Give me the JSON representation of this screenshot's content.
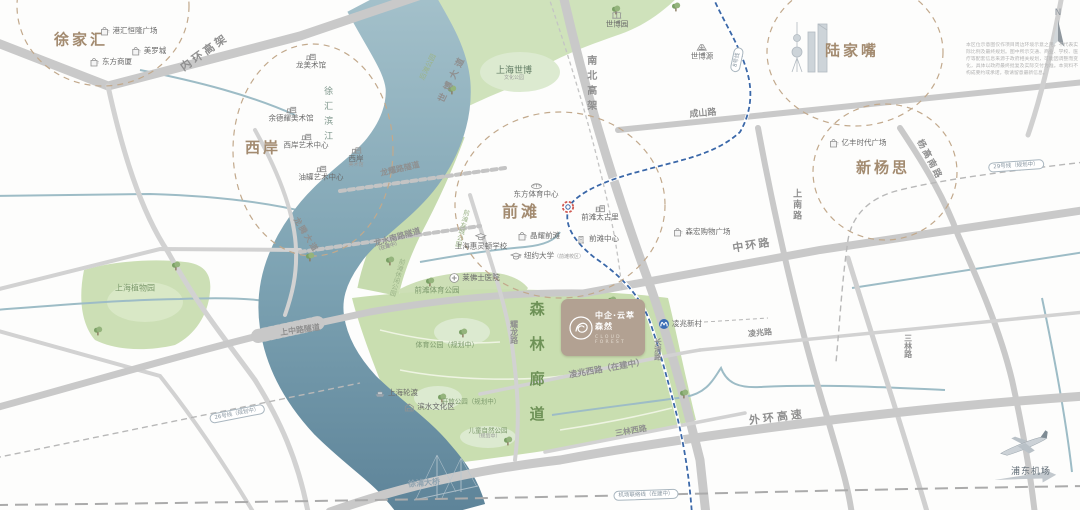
{
  "meta": {
    "compass_label": "N"
  },
  "project": {
    "name": "中企·云萃森然",
    "name_en": "CLOUD FOREST"
  },
  "airport": {
    "label": "浦东机场"
  },
  "disclaimer": "本区位示意图仅作项目周边环境示意之用，不代表实际比例及最终规划。图中所示交通、商业、学校、医疗等配套信息来源于政府相关规划，可能因调整而变化，具体以政府最终批复及实际交付为准。本资料不构成要约或承诺，敬请留意最新信息。",
  "map": {
    "width": 1080,
    "height": 510,
    "colors": {
      "district": "#a38b70",
      "road_label": "#8f8f8f",
      "river": "#7ca2b2",
      "park": "#cbdfb3",
      "metro_line8": "#3b68a8",
      "project_card": "#b2a192",
      "forest_text": "#6e9257"
    },
    "districts": [
      {
        "id": "district-xujiahui",
        "text": "徐家汇",
        "x": 81,
        "y": 40,
        "size": 15
      },
      {
        "id": "district-xian",
        "text": "西岸",
        "x": 263,
        "y": 148,
        "size": 15
      },
      {
        "id": "district-qiantan",
        "text": "前滩",
        "x": 521,
        "y": 212,
        "size": 16
      },
      {
        "id": "district-lujiazui",
        "text": "陆家嘴",
        "x": 852,
        "y": 51,
        "size": 15
      },
      {
        "id": "district-xinyangsi",
        "text": "新杨思",
        "x": 883,
        "y": 168,
        "size": 15
      }
    ],
    "road_labels": [
      {
        "id": "neihuan-elevated",
        "text": "内环高架",
        "x": 205,
        "y": 53,
        "rot": -35,
        "size": 11,
        "ls": 3
      },
      {
        "id": "nanbei-elevated",
        "text": "南北高架",
        "x": 590,
        "y": 85,
        "vertical": true,
        "size": 10,
        "ls": 5
      },
      {
        "id": "chengshan-road",
        "text": "成山路",
        "x": 703,
        "y": 114,
        "rot": -5,
        "size": 9
      },
      {
        "id": "yanggaonan-road",
        "text": "杨高南路",
        "x": 929,
        "y": 160,
        "rot": 62,
        "size": 9,
        "ls": 2
      },
      {
        "id": "shangnan-road",
        "text": "上南路",
        "x": 796,
        "y": 205,
        "vertical": true,
        "size": 9,
        "ls": 2
      },
      {
        "id": "zhonghuan-road",
        "text": "中环路",
        "x": 752,
        "y": 246,
        "rot": -9,
        "size": 11,
        "ls": 2
      },
      {
        "id": "shibo-avenue",
        "text": "世博大道",
        "x": 453,
        "y": 79,
        "rot": -64,
        "size": 9,
        "ls": 4
      },
      {
        "id": "longteng-avenue",
        "text": "龙腾大道",
        "x": 306,
        "y": 235,
        "rot": 58,
        "size": 8,
        "ls": 2
      },
      {
        "id": "longyao-road-tunnel",
        "text": "龙耀路隧道",
        "x": 400,
        "y": 169,
        "rot": -13,
        "size": 8
      },
      {
        "id": "longshuinan-road-tunnel",
        "lines": [
          "龙水南路隧道",
          "（在建中）"
        ],
        "x": 398,
        "y": 240,
        "rot": -16,
        "size": 8
      },
      {
        "id": "shangzhong-road-tunnel",
        "text": "上中路隧道",
        "x": 300,
        "y": 330,
        "rot": -8,
        "size": 8
      },
      {
        "id": "yaolong-road",
        "text": "耀龙路",
        "x": 514,
        "y": 332,
        "vertical": true,
        "size": 8
      },
      {
        "id": "changqing-road",
        "text": "长清路",
        "x": 657,
        "y": 349,
        "vertical": true,
        "size": 7.5
      },
      {
        "id": "lingzhaoxi-road",
        "text": "凌兆西路（在建中）",
        "x": 607,
        "y": 370,
        "rot": -10,
        "size": 8.5
      },
      {
        "id": "lingzhao-road",
        "text": "凌兆路",
        "x": 760,
        "y": 333,
        "rot": -5,
        "size": 8
      },
      {
        "id": "sanlinxi-road",
        "text": "三林西路",
        "x": 631,
        "y": 431,
        "rot": -10,
        "size": 8
      },
      {
        "id": "sanlin-road",
        "text": "三林路",
        "x": 908,
        "y": 346,
        "vertical": true,
        "size": 8
      },
      {
        "id": "waihuan-expressway",
        "text": "外环高速",
        "x": 777,
        "y": 418,
        "rot": -7,
        "size": 11,
        "ls": 3
      },
      {
        "id": "xupu-bridge",
        "text": "徐浦大桥",
        "x": 424,
        "y": 483,
        "rot": -5,
        "size": 8,
        "color": "#8fa3b0"
      }
    ],
    "transit_capsules": [
      {
        "id": "metro-line-8",
        "text": "8号线",
        "x": 737,
        "y": 60,
        "rot": -78
      },
      {
        "id": "metro-line-26-planned",
        "text": "26号线（规划中）",
        "x": 237,
        "y": 414,
        "rot": -11
      },
      {
        "id": "metro-line-29-planned",
        "text": "29号线（规划中）",
        "x": 1016,
        "y": 166,
        "rot": -4
      },
      {
        "id": "airport-link-line",
        "text": "机场联络线（在建中）",
        "x": 646,
        "y": 495,
        "rot": -2
      }
    ],
    "green_labels": [
      {
        "id": "houtan-park",
        "text": "后滩公园",
        "x": 428,
        "y": 67,
        "rot": -64,
        "size": 7,
        "color": "#9cb489"
      },
      {
        "id": "expo-culture-park",
        "lines": [
          "上海世博",
          "文化公园"
        ],
        "x": 514,
        "y": 74,
        "size": 9,
        "color": "#5f7a62"
      },
      {
        "id": "qiantan-youcheng-park",
        "text": "前滩友城公园",
        "x": 461,
        "y": 228,
        "vertical": true,
        "rot": 14,
        "size": 6.5,
        "color": "#9cb489"
      },
      {
        "id": "qiantan-xiuxian-park",
        "text": "前滩休闲公园",
        "x": 396,
        "y": 277,
        "vertical": true,
        "rot": 16,
        "size": 6.5,
        "color": "#9cb489"
      },
      {
        "id": "qiantan-sports-park",
        "text": "前滩体育公园",
        "x": 437,
        "y": 291,
        "size": 7.5,
        "color": "#7d9a6d"
      },
      {
        "id": "sports-park-planned",
        "text": "体育公园（规划中）",
        "x": 447,
        "y": 345,
        "size": 7,
        "color": "#7d9a6d"
      },
      {
        "id": "shanghai-botanical-garden",
        "text": "上海植物园",
        "x": 135,
        "y": 288,
        "size": 8,
        "color": "#7d9a6d"
      },
      {
        "id": "open-park-planned",
        "text": "开放公园（规划中）",
        "x": 471,
        "y": 402,
        "size": 6.5,
        "color": "#7d9a6d"
      },
      {
        "id": "children-nature-park-planned",
        "lines": [
          "儿童自然公园",
          "（规划中）"
        ],
        "x": 488,
        "y": 434,
        "size": 6.5,
        "color": "#7d9a6d"
      },
      {
        "id": "forest-corridor",
        "text": "森林廊道",
        "x": 536,
        "y": 371,
        "vertical": true,
        "size": 15,
        "bold": true,
        "ls": 20,
        "color": "#6e9257"
      },
      {
        "id": "xuhui-riverside",
        "text": "徐汇滨江",
        "x": 327,
        "y": 116,
        "vertical": true,
        "size": 9,
        "ls": 6,
        "color": "#7f978c"
      }
    ],
    "pois": [
      {
        "id": "ganghui-henglong-plaza",
        "icon": "bag",
        "text": "港汇恒隆广场",
        "x": 128,
        "y": 31
      },
      {
        "id": "metro-city",
        "icon": "bag",
        "text": "美罗城",
        "x": 148,
        "y": 51
      },
      {
        "id": "oriental-department-store",
        "icon": "bag",
        "text": "东方商厦",
        "x": 110,
        "y": 62
      },
      {
        "id": "long-museum",
        "icon": "museum",
        "text": "龙美术馆",
        "x": 311,
        "y": 60,
        "iconPos": "top"
      },
      {
        "id": "yuz-museum",
        "icon": "museum",
        "text": "余德耀美术馆",
        "x": 291,
        "y": 113,
        "iconPos": "top"
      },
      {
        "id": "west-bund-art-center",
        "icon": "museum",
        "text": "西岸艺术中心",
        "x": 306,
        "y": 140,
        "iconPos": "top"
      },
      {
        "id": "west-bund-museum",
        "icon": "museum",
        "lines": [
          "西岸",
          "美术馆"
        ],
        "x": 356,
        "y": 156,
        "iconPos": "top"
      },
      {
        "id": "tank-art-center",
        "icon": "museum",
        "text": "油罐艺术中心",
        "x": 321,
        "y": 172,
        "iconPos": "top"
      },
      {
        "id": "expo-garden",
        "icon": "trellis",
        "text": "世博园",
        "x": 617,
        "y": 19,
        "iconPos": "top"
      },
      {
        "id": "expo-source",
        "icon": "pavilion",
        "text": "世博源",
        "x": 702,
        "y": 51,
        "iconPos": "top"
      },
      {
        "id": "yifeng-times-plaza",
        "icon": "bag",
        "text": "亿丰时代广场",
        "x": 857,
        "y": 143
      },
      {
        "id": "oriental-sports-center",
        "icon": "stadium",
        "text": "东方体育中心",
        "x": 536,
        "y": 189,
        "iconPos": "top"
      },
      {
        "id": "qiantan-taikoo-li",
        "icon": "mall",
        "text": "前滩太古里",
        "x": 600,
        "y": 212,
        "iconPos": "top"
      },
      {
        "id": "crystal-plaza-qiantan",
        "icon": "bag",
        "text": "晶耀前滩",
        "x": 538,
        "y": 236
      },
      {
        "id": "qiantan-center",
        "icon": "tower",
        "text": "前滩中心",
        "x": 597,
        "y": 239
      },
      {
        "id": "nyu-shanghai-qiantan",
        "icon": "school",
        "text": "纽约大学",
        "sub": "（前滩校区）",
        "x": 547,
        "y": 256
      },
      {
        "id": "wellington-college-shanghai",
        "icon": "school",
        "text": "上海惠灵顿学校",
        "x": 481,
        "y": 241,
        "iconPos": "top"
      },
      {
        "id": "raffles-hospital",
        "icon": "hospital",
        "text": "莱佛士医院",
        "x": 474,
        "y": 278
      },
      {
        "id": "senhong-shopping-plaza",
        "icon": "bag",
        "text": "森宏购物广场",
        "x": 701,
        "y": 232
      },
      {
        "id": "shanghai-ferry",
        "icon": "ferry",
        "text": "上海轮渡",
        "x": 396,
        "y": 393
      },
      {
        "id": "binshui-culture-zone",
        "icon": "culture",
        "text": "滨水文化区",
        "x": 429,
        "y": 407
      },
      {
        "id": "lingzhao-xincun-station",
        "icon": "metro",
        "text": "凌兆新村",
        "x": 680,
        "y": 324
      }
    ]
  }
}
